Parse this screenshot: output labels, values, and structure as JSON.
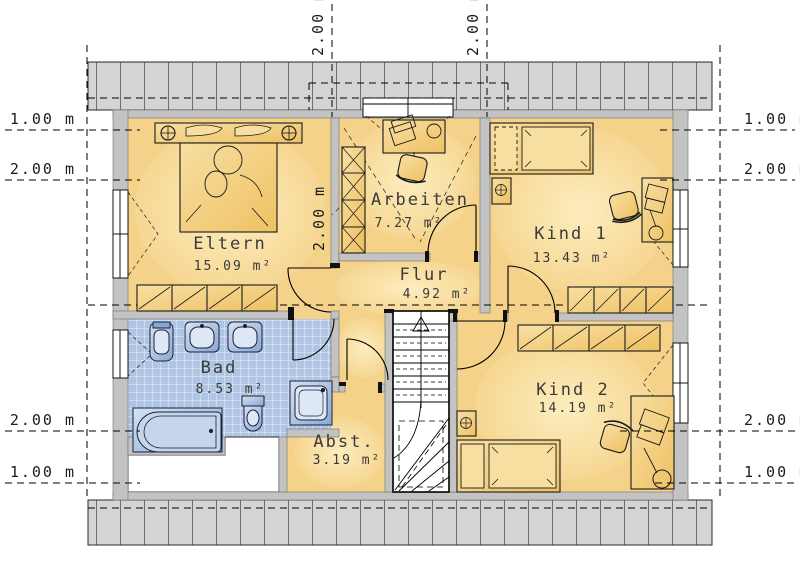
{
  "plan": {
    "type": "floor-plan",
    "floor": "Dachgeschoss (attic floor)",
    "rooms": [
      {
        "id": "eltern",
        "name": "Eltern",
        "area": "15.09 m²"
      },
      {
        "id": "arbeiten",
        "name": "Arbeiten",
        "area": "7.27 m²"
      },
      {
        "id": "kind1",
        "name": "Kind 1",
        "area": "13.43 m²"
      },
      {
        "id": "flur",
        "name": "Flur",
        "area": "4.92 m²"
      },
      {
        "id": "bad",
        "name": "Bad",
        "area": "8.53 m²"
      },
      {
        "id": "abst",
        "name": "Abst.",
        "area": "3.19 m²"
      },
      {
        "id": "kind2",
        "name": "Kind 2",
        "area": "14.19 m²"
      }
    ],
    "dimensions": {
      "left": [
        "1.00 m",
        "2.00 m",
        "2.00 m",
        "1.00 m"
      ],
      "right": [
        "1.00 m",
        "2.00 m",
        "2.00 m",
        "1.00 m"
      ],
      "top": [
        "2.00 m",
        "2.00 m"
      ],
      "interior": [
        "2.00 m"
      ]
    },
    "colors": {
      "floor": "#f5d289",
      "floor_light": "#fdf0c4",
      "wall": "#c3c3c3",
      "roof_strip": "#d4d4d4",
      "tile": "#b0c5e3",
      "fixture": "#9fb8dc",
      "fixture_light": "#ccdaef",
      "furniture": "#f3cb77",
      "line": "#000000"
    }
  }
}
